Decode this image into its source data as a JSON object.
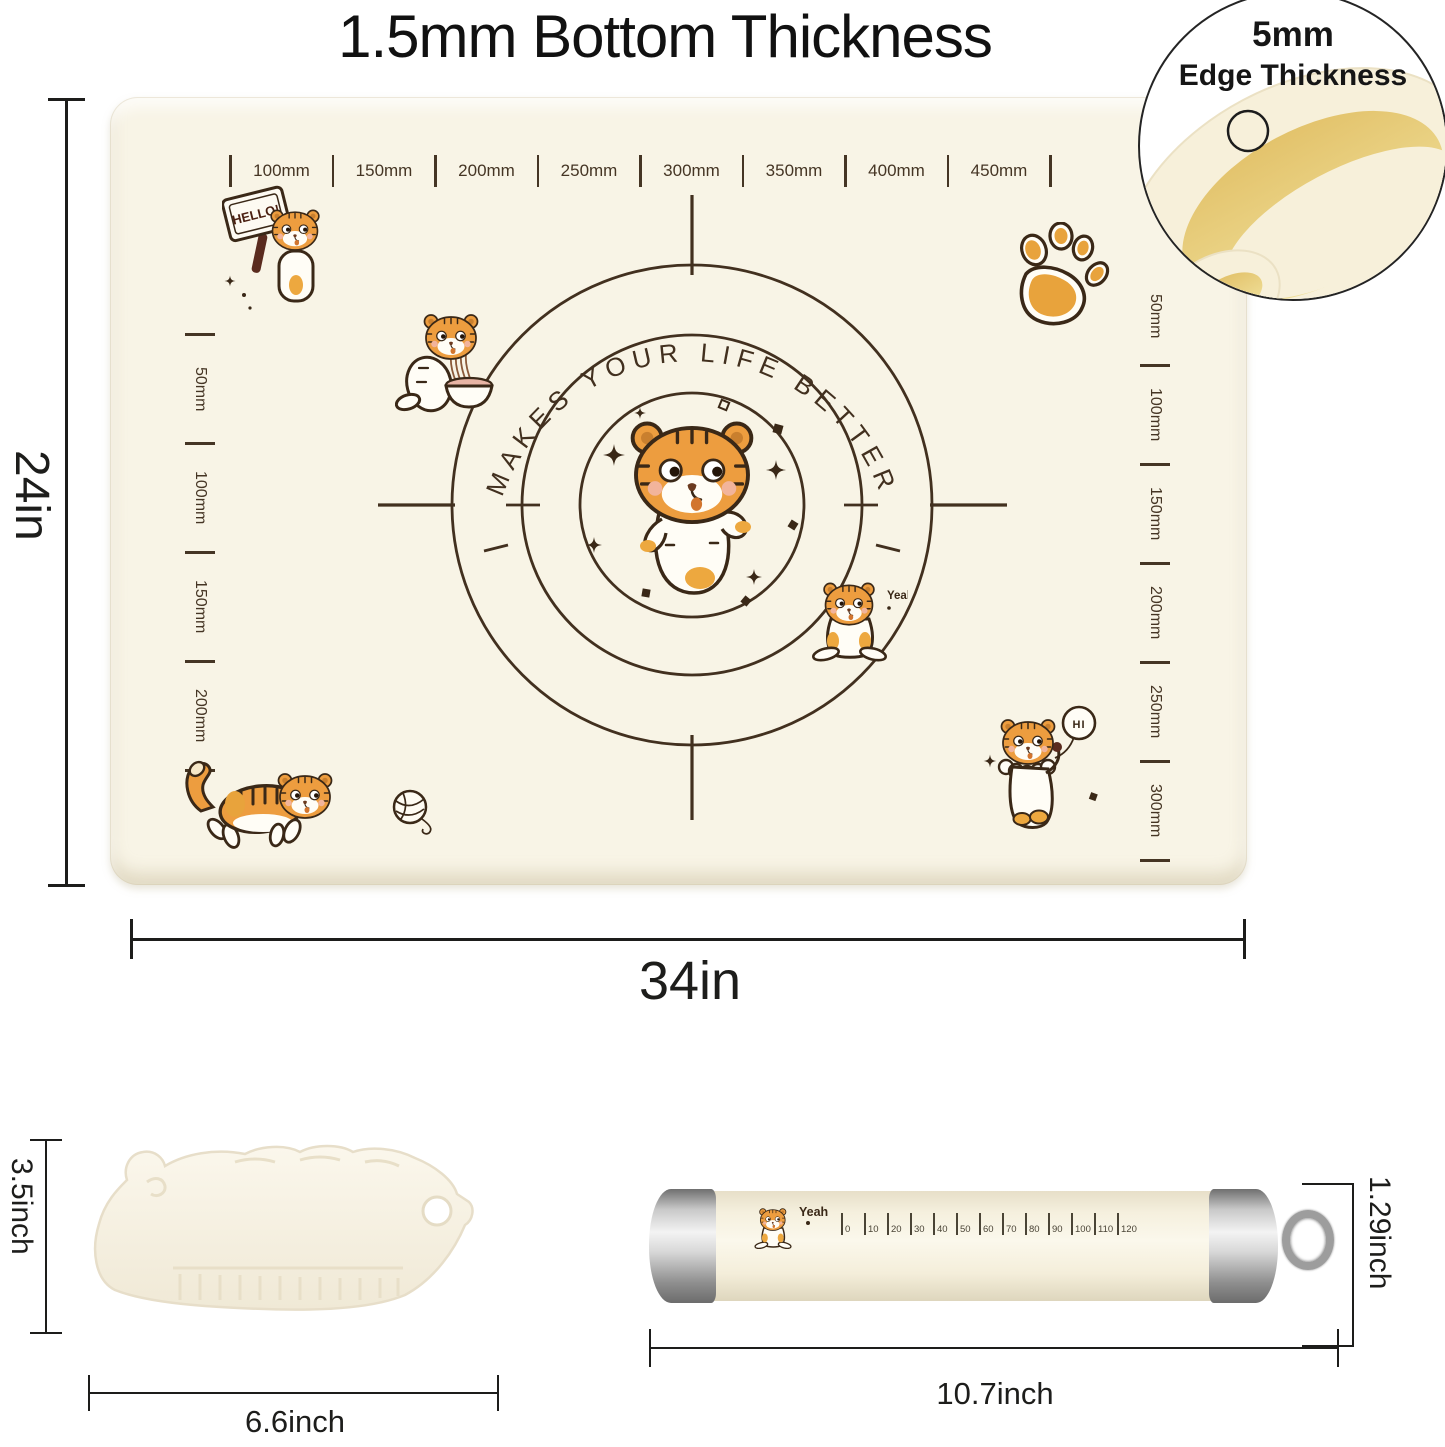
{
  "title": "1.5mm Bottom Thickness",
  "inset": {
    "line1": "5mm",
    "line2": "Edge Thickness"
  },
  "mat": {
    "top_ruler": [
      "100mm",
      "150mm",
      "200mm",
      "250mm",
      "300mm",
      "350mm",
      "400mm",
      "450mm"
    ],
    "left_ruler": [
      "50mm",
      "100mm",
      "150mm",
      "200mm"
    ],
    "right_ruler": [
      "50mm",
      "100mm",
      "150mm",
      "200mm",
      "250mm",
      "300mm"
    ],
    "center_text": "MAKES YOUR LIFE BETTER",
    "stickers": {
      "hello": "HELLO!",
      "yeah": "Yeah",
      "hi": "HI"
    }
  },
  "dimensions": {
    "mat_height": "24in",
    "mat_width": "34in",
    "scraper_height": "3.5inch",
    "scraper_width": "6.6inch",
    "pin_length": "10.7inch",
    "pin_diameter": "1.29inch"
  },
  "rolling_pin": {
    "yeah": "Yeah",
    "scale": [
      "0",
      "10",
      "20",
      "30",
      "40",
      "50",
      "60",
      "70",
      "80",
      "90",
      "100",
      "110",
      "120"
    ]
  },
  "colors": {
    "mat": "#f8f4e6",
    "line_brown": "#3a2817",
    "tiger_orange": "#ed9d3f",
    "inset_yellow": "#e9d07e",
    "dim_line": "#1d1d1b"
  }
}
